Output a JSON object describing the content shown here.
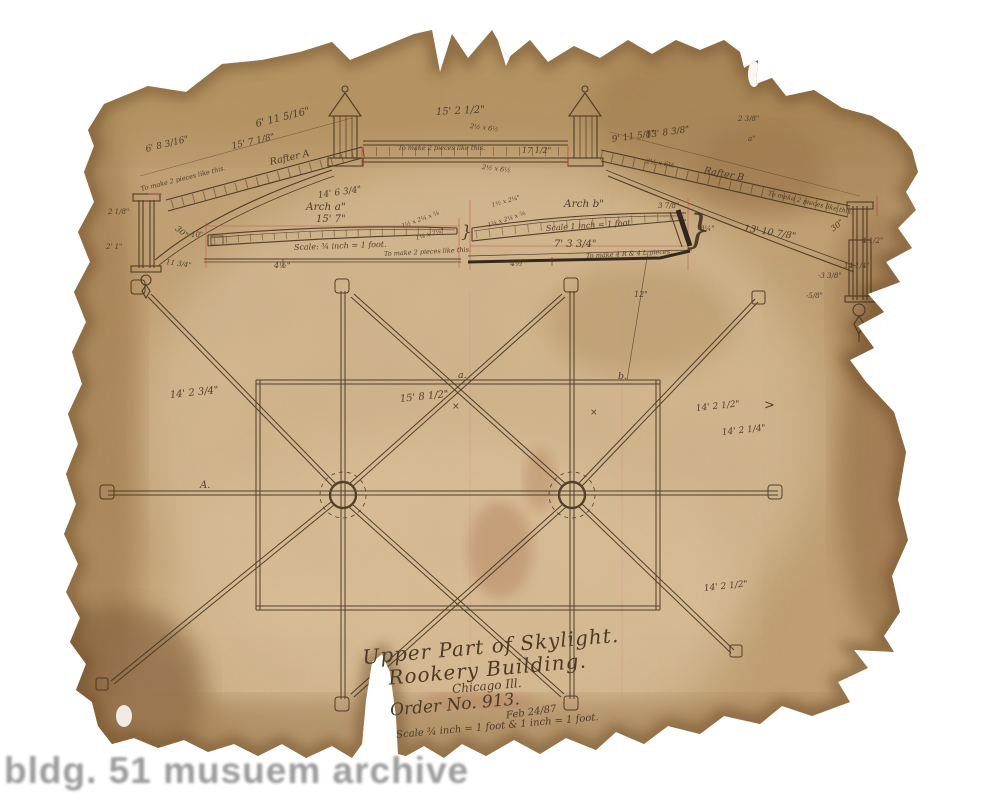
{
  "watermark": "bldg. 51 musuem archive",
  "title_block": {
    "line1": "Upper Part of Skylight.",
    "line2": "Rookery Building.",
    "line3": "Chicago Ill.",
    "order": "Order No. 913.",
    "date": "Feb 24/87",
    "scale": "Scale ¾ inch = 1 foot & 1 inch = 1 foot."
  },
  "colors": {
    "paper": "#c3a173",
    "ink": "#43331f",
    "red": "#b54a44"
  },
  "annotations": [
    {
      "text": "6' 8 3/16\"",
      "x": 146,
      "y": 146,
      "rot": -14,
      "size": 9
    },
    {
      "text": "6' 11 5/16\"",
      "x": 256,
      "y": 120,
      "rot": -14,
      "size": 10
    },
    {
      "text": "15' 7 1/8\"",
      "x": 232,
      "y": 143,
      "rot": -13,
      "size": 9
    },
    {
      "text": "Rafter A",
      "x": 270,
      "y": 158,
      "rot": -13,
      "size": 9.5
    },
    {
      "text": "To make 2 pieces like this.",
      "x": 141,
      "y": 186,
      "rot": -14,
      "size": 6.5
    },
    {
      "text": "14' 6 3/4\"",
      "x": 318,
      "y": 192,
      "rot": -8,
      "size": 9
    },
    {
      "text": "2 1/8\"",
      "x": 108,
      "y": 209,
      "rot": 0,
      "size": 7
    },
    {
      "text": "2' 1\"",
      "x": 106,
      "y": 244,
      "rot": 0,
      "size": 7
    },
    {
      "text": "30\"",
      "x": 176,
      "y": 224,
      "rot": 38,
      "size": 8
    },
    {
      "text": "11 3/4\"",
      "x": 166,
      "y": 259,
      "rot": 8,
      "size": 7
    },
    {
      "text": "15' 2 1/2\"",
      "x": 436,
      "y": 108,
      "rot": -3,
      "size": 10
    },
    {
      "text": "2½ x 6½",
      "x": 470,
      "y": 123,
      "rot": 7,
      "size": 6.5
    },
    {
      "text": "To make 2 pieces like this.",
      "x": 398,
      "y": 145,
      "rot": 0,
      "size": 6.5
    },
    {
      "text": "2½ x 6½",
      "x": 482,
      "y": 164,
      "rot": 7,
      "size": 6.5
    },
    {
      "text": "17 1/2\"",
      "x": 522,
      "y": 147,
      "rot": 0,
      "size": 8
    },
    {
      "text": "9' 11 5/8\"",
      "x": 612,
      "y": 136,
      "rot": -8,
      "size": 9
    },
    {
      "text": "13' 8 3/8\"",
      "x": 646,
      "y": 132,
      "rot": -8,
      "size": 9
    },
    {
      "text": "2 3/8\"",
      "x": 738,
      "y": 116,
      "rot": 0,
      "size": 7
    },
    {
      "text": "a\"",
      "x": 748,
      "y": 136,
      "rot": 0,
      "size": 7
    },
    {
      "text": "Rafter B",
      "x": 704,
      "y": 166,
      "rot": 11,
      "size": 9.5
    },
    {
      "text": "2½ x 6½",
      "x": 646,
      "y": 158,
      "rot": 9,
      "size": 6.5
    },
    {
      "text": "To make 2 pieces like this.",
      "x": 768,
      "y": 190,
      "rot": 13,
      "size": 6.5
    },
    {
      "text": "13' 10 7/8\"",
      "x": 744,
      "y": 224,
      "rot": 9,
      "size": 9.5
    },
    {
      "text": "30\"",
      "x": 832,
      "y": 226,
      "rot": -38,
      "size": 8
    },
    {
      "text": "4 1/2\"",
      "x": 862,
      "y": 238,
      "rot": 0,
      "size": 7
    },
    {
      "text": "14 1/4\"",
      "x": 844,
      "y": 263,
      "rot": 0,
      "size": 7
    },
    {
      "text": "-3 3/8\"",
      "x": 818,
      "y": 273,
      "rot": 0,
      "size": 7
    },
    {
      "text": "-5/8\"",
      "x": 806,
      "y": 293,
      "rot": 0,
      "size": 7
    },
    {
      "text": "Arch a\"",
      "x": 306,
      "y": 202,
      "rot": 0,
      "size": 10.5
    },
    {
      "text": "15' 7\"",
      "x": 316,
      "y": 215,
      "rot": 0,
      "size": 10
    },
    {
      "text": "1½ x 2¼ x ⅝",
      "x": 402,
      "y": 224,
      "rot": -20,
      "size": 6
    },
    {
      "text": "1¼ x 2¼\"",
      "x": 416,
      "y": 236,
      "rot": -16,
      "size": 6
    },
    {
      "text": "Scale: ¾ inch = 1 foot.",
      "x": 294,
      "y": 244,
      "rot": -2,
      "size": 8
    },
    {
      "text": "To make 2 pieces like this.",
      "x": 384,
      "y": 251,
      "rot": -3,
      "size": 6.5
    },
    {
      "text": "4½\"",
      "x": 274,
      "y": 262,
      "rot": 0,
      "size": 8
    },
    {
      "text": "10\"",
      "x": 191,
      "y": 232,
      "rot": 0,
      "size": 7
    },
    {
      "text": "}",
      "x": 461,
      "y": 224,
      "rot": 0,
      "size": 17
    },
    {
      "text": "Arch b\"",
      "x": 564,
      "y": 199,
      "rot": 0,
      "size": 10.5
    },
    {
      "text": "1½ x 2¼\"",
      "x": 492,
      "y": 203,
      "rot": -16,
      "size": 6
    },
    {
      "text": "1¼ x 2¼ x ⅝",
      "x": 488,
      "y": 223,
      "rot": -18,
      "size": 6
    },
    {
      "text": "Scale 1 inch = 1 foot",
      "x": 546,
      "y": 225,
      "rot": -4,
      "size": 8
    },
    {
      "text": "7' 3 3/4\"",
      "x": 554,
      "y": 240,
      "rot": 0,
      "size": 10
    },
    {
      "text": "3 7/8\"",
      "x": 658,
      "y": 203,
      "rot": 0,
      "size": 7
    },
    {
      "text": "To make 4 R & 4 L pieces.",
      "x": 586,
      "y": 253,
      "rot": -3,
      "size": 6.5
    },
    {
      "text": "4½\"",
      "x": 510,
      "y": 260,
      "rot": 0,
      "size": 8
    },
    {
      "text": "8¼\"",
      "x": 700,
      "y": 226,
      "rot": 0,
      "size": 7
    },
    {
      "text": "}",
      "x": 686,
      "y": 210,
      "rot": 0,
      "size": 40
    },
    {
      "text": "14' 2 3/4\"",
      "x": 170,
      "y": 391,
      "rot": -6,
      "size": 10
    },
    {
      "text": "15' 8 1/2\"",
      "x": 400,
      "y": 395,
      "rot": -6,
      "size": 10
    },
    {
      "text": "14' 2 1/2\"",
      "x": 696,
      "y": 405,
      "rot": -6,
      "size": 9
    },
    {
      "text": "14' 2 1/4\"",
      "x": 722,
      "y": 429,
      "rot": -6,
      "size": 9
    },
    {
      "text": "14' 2 1/2\"",
      "x": 704,
      "y": 585,
      "rot": -6,
      "size": 9
    },
    {
      "text": "a.",
      "x": 458,
      "y": 371,
      "rot": 0,
      "size": 9.5
    },
    {
      "text": "b.",
      "x": 618,
      "y": 372,
      "rot": 0,
      "size": 9.5
    },
    {
      "text": "A.",
      "x": 200,
      "y": 481,
      "rot": 0,
      "size": 10
    },
    {
      "text": "12\"",
      "x": 634,
      "y": 291,
      "rot": 0,
      "size": 8
    },
    {
      "text": ">",
      "x": 764,
      "y": 399,
      "rot": 0,
      "size": 13
    },
    {
      "text": "×",
      "x": 452,
      "y": 403,
      "rot": 0,
      "size": 9
    },
    {
      "text": "×",
      "x": 590,
      "y": 409,
      "rot": 0,
      "size": 9
    }
  ]
}
